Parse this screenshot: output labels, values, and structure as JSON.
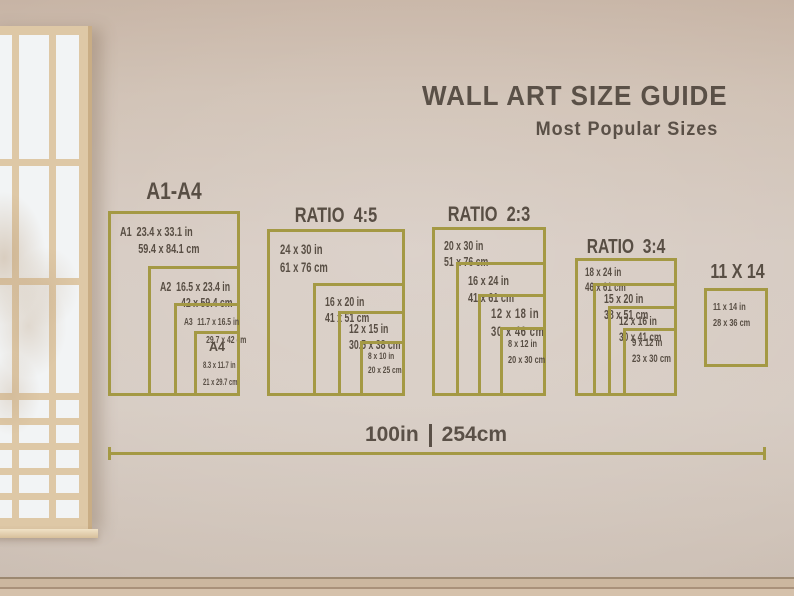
{
  "title": "WALL ART SIZE GUIDE",
  "subtitle": "Most Popular Sizes",
  "colors": {
    "accent_gold": "#a49944",
    "text": "#584e44"
  },
  "groups": [
    {
      "header": "A1-A4",
      "sizes": [
        {
          "name": "A1",
          "inches": "23.4 x 33.1 in",
          "cm": "59.4 x 84.1 cm"
        },
        {
          "name": "A2",
          "inches": "16.5 x 23.4 in",
          "cm": "42 x 59.4 cm"
        },
        {
          "name": "A3",
          "inches": "11.7 x 16.5 in",
          "cm": "29.7 x 42 cm"
        },
        {
          "name": "A4",
          "inches": "8.3 x 11.7 in",
          "cm": "21 x 29.7 cm"
        }
      ]
    },
    {
      "header": "RATIO  4:5",
      "sizes": [
        {
          "inches": "24 x 30 in",
          "cm": "61 x 76 cm"
        },
        {
          "inches": "16 x 20 in",
          "cm": "41 x 51 cm"
        },
        {
          "inches": "12 x 15 in",
          "cm": "30.5 x 38 cm"
        },
        {
          "inches": "8 x 10 in",
          "cm": "20 x 25 cm"
        }
      ]
    },
    {
      "header": "RATIO  2:3",
      "sizes": [
        {
          "inches": "20 x 30 in",
          "cm": "51 x 76 cm"
        },
        {
          "inches": "16 x 24 in",
          "cm": "41 x 61 cm"
        },
        {
          "inches": "12 x 18 in",
          "cm": "30 x 46 cm"
        },
        {
          "inches": "8 x 12 in",
          "cm": "20 x 30 cm"
        }
      ]
    },
    {
      "header": "RATIO  3:4",
      "sizes": [
        {
          "inches": "18 x 24 in",
          "cm": "46 x 61 cm"
        },
        {
          "inches": "15 x 20 in",
          "cm": "38 x 51 cm"
        },
        {
          "inches": "12 x 16 in",
          "cm": "30 x 41 cm"
        },
        {
          "inches": "9 x 12 in",
          "cm": "23 x 30 cm"
        }
      ]
    },
    {
      "header": "11 X 14",
      "sizes": [
        {
          "inches": "11 x 14 in",
          "cm": "28 x 36 cm"
        }
      ]
    }
  ],
  "scale": {
    "inches": "100in",
    "cm": "254cm"
  }
}
